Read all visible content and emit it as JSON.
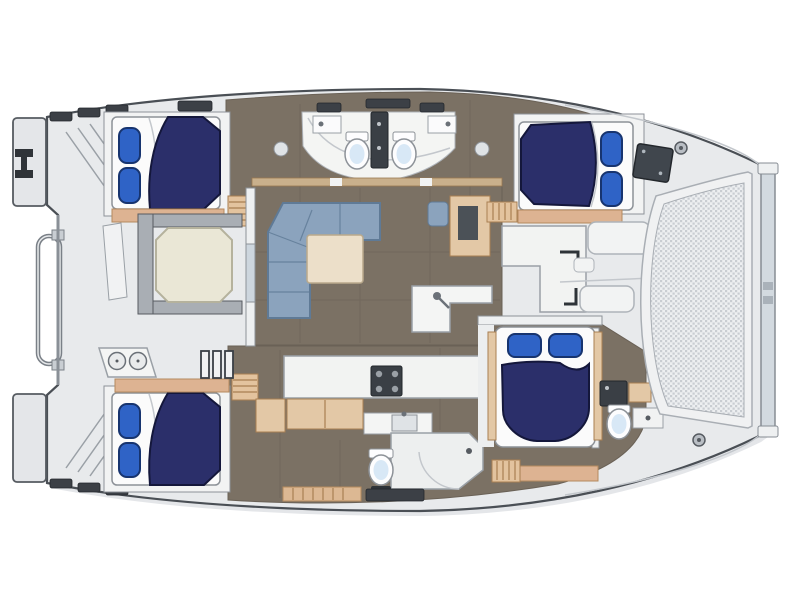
{
  "meta": {
    "title": "Catamaran yacht floor plan – top view",
    "diagram_type": "boat-floorplan",
    "orientation": {
      "bow": "right",
      "stern": "left"
    }
  },
  "palette": {
    "page_bg": "#ffffff",
    "deck": "#e8eaec",
    "deck_shadow": "#d9dce0",
    "outline": "#4a4f55",
    "floor": "#7b7164",
    "floor_seam": "#6a6156",
    "cabin_sole": "#f2f3f3",
    "wood": "#e3c8a6",
    "wood_dark": "#a87f52",
    "beam": "#ddb392",
    "table_cream": "#eae7d6",
    "table_wood": "#ecdfc9",
    "white_fixture": "#f2f3f2",
    "fixture_line": "#9aa0a6",
    "bed": "#2b2f6a",
    "bed_line": "#14173b",
    "pillow": "#2f63c6",
    "pillow_line": "#17346f",
    "sofa": "#8ba3bd",
    "sofa_line": "#5f7a96",
    "bench": "#a9aeb4",
    "dark_fixture": "#3a3f45",
    "mesh_frame": "#f0f1f2",
    "mesh_base": "#edeff1",
    "mesh_dot": "#c9cdd2",
    "porcelain": "#fdfdfe",
    "porcelain_glow": "#d8e8f6",
    "beam_bar": "#d3dae0",
    "glass": "#cdd6de"
  },
  "legend": {
    "vessel": "sailing catamaran, twin hulls, viewed from above",
    "features": [
      "4 double berths with navy duvets and blue pillows",
      "4 heads (2 back-to-back toilets amidships top hull, 1 mid bottom hull, 1 forward)",
      "L-shaped salon settee with wood coffee table",
      "aft cockpit with octagonal dining table and benches",
      "galley counter with 4-burner stove, sinks and wet bar",
      "companionway steps into each hull",
      "bow trampoline mesh with forward crossbeam",
      "stern swim platforms, transom steps and davit frame",
      "anchor-locker hatch and deck cleats on foredeck"
    ],
    "counts": {
      "cabins": 4,
      "berths": 4,
      "toilets": 4,
      "showers": 2,
      "tables": 2,
      "sofas": 1
    }
  }
}
